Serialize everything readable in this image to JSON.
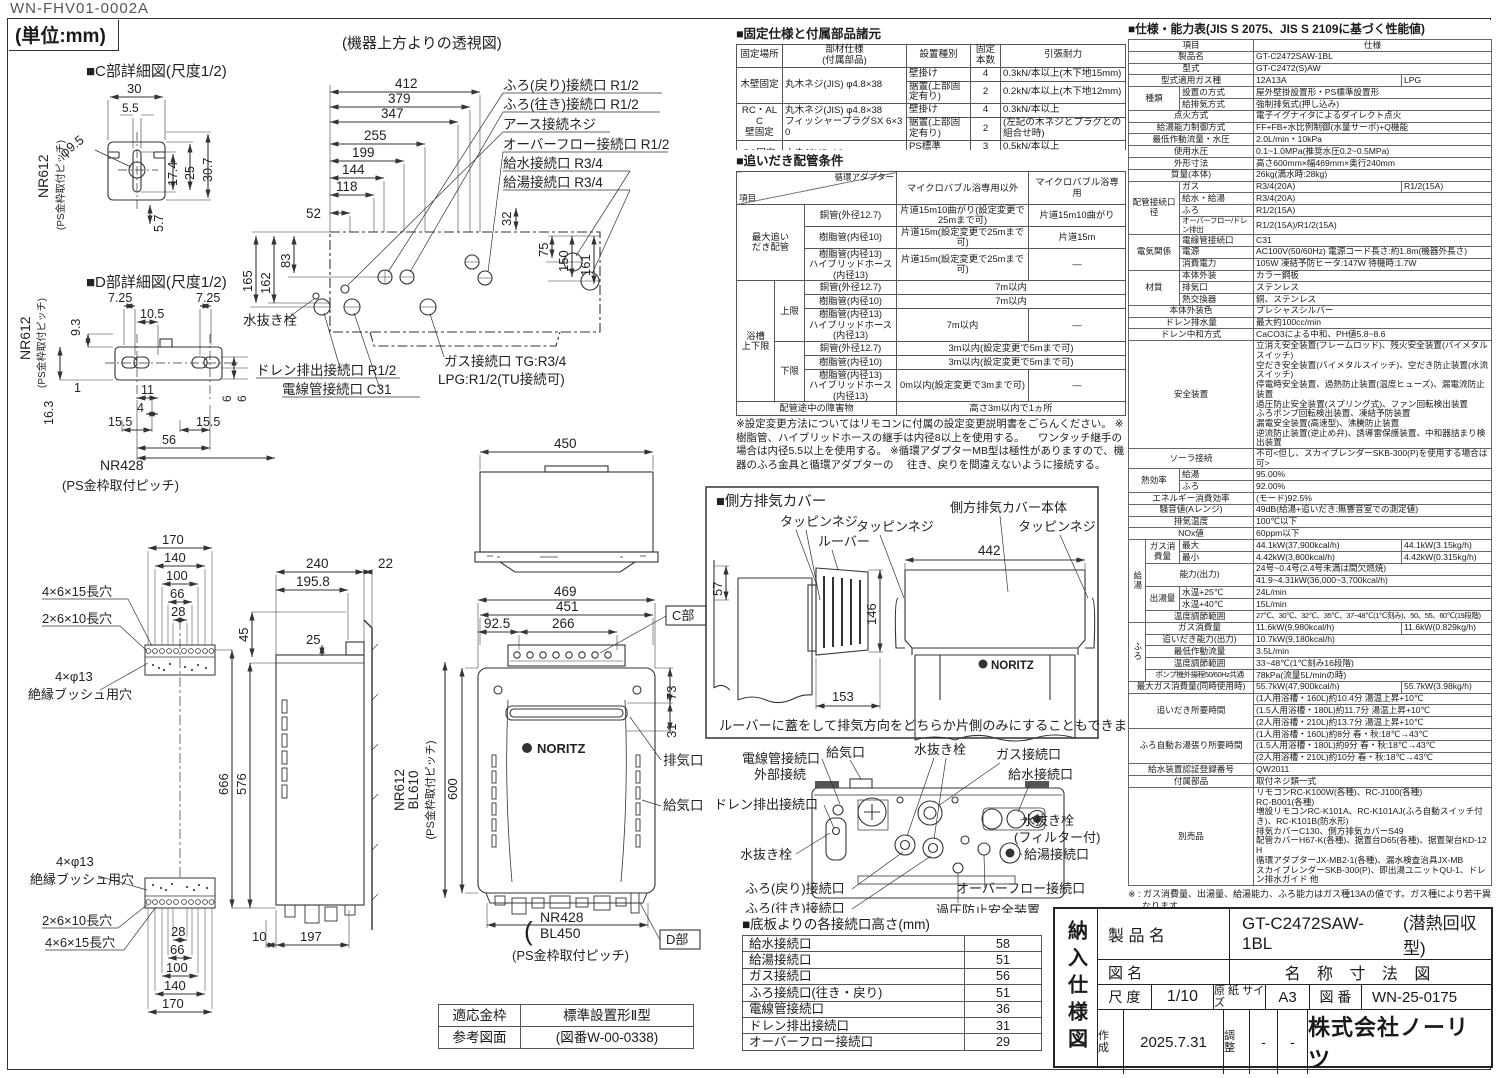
{
  "page": {
    "doc_code": "WN-FHV01-0002A",
    "unit_note": "(単位:mm)"
  },
  "c_detail": {
    "title": "■C部詳細図(尺度1/2)",
    "d30": "30",
    "d55": "5.5",
    "dphi": "φ9.5",
    "d174": "17.4",
    "d25": "25",
    "d307": "30.7",
    "d57": "5.7",
    "pitch": "NR612",
    "pitch_sub": "(PS金枠取付ピッチ)"
  },
  "d_detail": {
    "title": "■D部詳細図(尺度1/2)",
    "d725l": "7.25",
    "d105": "10.5",
    "d725r": "7.25",
    "d93": "9.3",
    "d1": "1",
    "d163": "16.3",
    "d11": "11",
    "d4": "4",
    "d155l": "15.5",
    "d155r": "15.5",
    "d56": "56",
    "d6a": "6",
    "d6b": "6",
    "pitch": "NR612",
    "pitch_sub": "(PS金枠取付ピッチ)",
    "pitch2": "NR428",
    "pitch2_sub": "(PS金枠取付ピッチ)"
  },
  "top_view": {
    "title": "(機器上方よりの透視図)",
    "d412": "412",
    "d379": "379",
    "d347": "347",
    "d255": "255",
    "d199": "199",
    "d144": "144",
    "d118": "118",
    "d52": "52",
    "d165": "165",
    "d162": "162",
    "d83": "83",
    "d32": "32",
    "d75": "75",
    "d150": "150",
    "d161": "161",
    "labels": {
      "furo_return": "ふろ(戻り)接続口 R1/2",
      "furo_go": "ふろ(往き)接続口 R1/2",
      "earth": "アース接続ネジ",
      "overflow": "オーバーフロー接続口 R1/2",
      "water_in": "給水接続口 R3/4",
      "hot_out": "給湯接続口 R3/4",
      "drain_plug": "水抜き栓",
      "drain_out": "ドレン排出接続口 R1/2",
      "conduit": "電線管接続口 C31",
      "gas1": "ガス接続口 TG:R3/4",
      "gas2": "LPG:R1/2(TU接続可)"
    }
  },
  "front_view": {
    "d450": "450",
    "d469": "469",
    "d451": "451",
    "d925": "92.5",
    "d266": "266",
    "d73": "73",
    "d31": "31",
    "d600": "600",
    "c_part": "C部",
    "d_part": "D部",
    "exhaust": "排気口",
    "air_in": "給気口",
    "logo": "NORITZ",
    "nr612": "NR612",
    "bl610": "BL610",
    "ps_pitch_l": "(PS金枠取付ピッチ)",
    "nr428": "NR428",
    "bl450": "BL450",
    "ps_pitch_b": "(PS金枠取付ピッチ)"
  },
  "side_view": {
    "d240": "240",
    "d22": "22",
    "d1958": "195.8",
    "d25": "25",
    "d45": "45",
    "d666": "666",
    "d576": "576",
    "d10": "10",
    "d197": "197"
  },
  "brackets": {
    "hole_a": "4×6×15長穴",
    "hole_b": "2×6×10長穴",
    "hole_c": "4×φ13",
    "hole_c_sub": "絶縁ブッシュ用穴",
    "t170": "170",
    "t140": "140",
    "t100": "100",
    "t66": "66",
    "t28": "28",
    "b28": "28",
    "b66": "66",
    "b100": "100",
    "b140": "140",
    "b170": "170"
  },
  "side_cover": {
    "title": "■側方排気カバー",
    "tapping": "タッピンネジ",
    "louver": "ルーバー",
    "body_label": "側方排気カバー本体",
    "d57": "57",
    "d146": "146",
    "d153": "153",
    "d442": "442",
    "logo": "NORITZ",
    "note": "ルーバーに蓋をして排気方向をどちらか片側のみにすることもできます。"
  },
  "rear_view": {
    "conduit": "電線管接続口",
    "external": "外部接続",
    "air_in": "給気口",
    "drain_plug_top": "水抜き栓",
    "gas": "ガス接続口",
    "water_in": "給水接続口",
    "drain_out": "ドレン排出接続口",
    "drain_plug_left": "水抜き栓",
    "drain_plug_filter": "水抜き栓",
    "filter_sub": "(フィルター付)",
    "hot_out": "給湯接続口",
    "furo_return": "ふろ(戻り)接続口",
    "furo_go": "ふろ(往き)接続口",
    "overflow": "オーバーフロー接続口",
    "relief": "過圧防止安全装置",
    "relief_sub": "(水抜き栓付)"
  },
  "fix_table": {
    "title": "■固定仕様と付属部品諸元",
    "headers": [
      "固定場所",
      [
        "部材仕様",
        "(付属部品)"
      ],
      "設置種別",
      "固定本数",
      "引張耐力"
    ],
    "wood": {
      "place": "木壁固定",
      "part": "丸木ネジ(JIS) φ4.8×38",
      "t1": "壁掛け",
      "n1": "4",
      "p1": "0.3kN/本以上(木下地15mm)",
      "t2": "据置(上部固定有り)",
      "n2": "2",
      "p2": "0.2kN/本以上(木下地12mm)"
    },
    "rc": {
      "place": [
        "RC・ALC",
        "壁固定"
      ],
      "part": [
        "丸木ネジ(JIS) φ4.8×38",
        "フィッシャープラグSX 6×30"
      ],
      "t1": "壁掛け",
      "n1": "4",
      "p1": "0.3kN/本以上",
      "t2": "据置(上部固定有り)",
      "n2": "2",
      "p2": "(左記の木ネジとプラグとの組合せ時)"
    },
    "ps": {
      "place": "PS固定",
      "part": "小ネジM5×12",
      "t": "PS標準",
      "n": "3",
      "p": "0.5kN/本以上"
    },
    "note": [
      "※本製品の設置・転倒防止の措置は、国土交通省告示第1447号「建築設備の構造耐力上安全な構造方法を",
      "　定める件の一部を改訂する件」に対応しています。"
    ]
  },
  "oidaki": {
    "title": "■追いだき配管条件",
    "h_item": "項目",
    "h_adapter": "循環アダプター",
    "h_col1": "マイクロバブル浴専用以外",
    "h_col2": "マイクロバブル浴専用",
    "g1": [
      "最大追い",
      "だき配管"
    ],
    "g2": [
      "浴槽",
      "上下限"
    ],
    "sub_up": "上限",
    "sub_down": "下限",
    "pipe_cu": "銅管(外径12.7)",
    "pipe_resin": "樹脂管(内径10)",
    "pipe_resin13": [
      "樹脂管(内径13)",
      "ハイブリッドホース(内径13)"
    ],
    "r1v1": "片道15m10曲がり(設定変更で25mまで可)",
    "r1v2": "片道15m10曲がり",
    "r2v1": "片道15m(設定変更で25mまで可)",
    "r2v2": "片道15m",
    "r3v1": "片道15m(設定変更で25mまで可)",
    "dash": "―",
    "r4v": "7m以内",
    "r6v1": "7m以内",
    "r7v": "3m以内(設定変更で5mまで可)",
    "r9v1": "0m以内(設定変更で3mまで可)",
    "obstacle_label": "配管途中の障害物",
    "obstacle_value": "高さ3m以内で1ヵ所",
    "notes": [
      "※設定変更方法についてはリモコンに付属の設定変更説明書をごらんください。",
      "※樹脂管、ハイブリッドホースの継手は内径8以上を使用する。",
      "　ワンタッチ継手の場合は内径5.5以上を使用する。",
      "※循環アダプターMB型は極性がありますので、機器のふろ金具と循環アダプターの",
      "　往き、戻りを間違えないように接続する。"
    ]
  },
  "spec": {
    "title": "■仕様・能力表(JIS S 2075、JIS S 2109に基づく性能値)",
    "rows": [
      [
        "項目",
        "仕様"
      ],
      [
        "製品名",
        "GT-C2472SAW-1BL"
      ],
      [
        "型式",
        "GT-C2472(S)AW"
      ],
      [
        "型式適用ガス種",
        "12A13A",
        "LPG"
      ],
      [
        "種類",
        "設置の方式",
        "屋外壁掛設置形・PS標準設置形"
      ],
      [
        "給排気方式",
        "強制排気式(押し込み)"
      ],
      [
        "点火方式",
        "電子イグナイタによるダイレクト点火"
      ],
      [
        "給湯能力制御方式",
        "FF+FB+水比例制御(水量サーボ)+Q機能"
      ],
      [
        "最低作動流量・水圧",
        "2.0L/min・10kPa"
      ],
      [
        "使用水圧",
        "0.1~1.0MPa(推奨水圧0.2~0.5MPa)"
      ],
      [
        "外形寸法",
        "高さ600mm×幅469mm×奥行240mm"
      ],
      [
        "質量(本体)",
        "26kg(満水時:28kg)"
      ],
      [
        "配管接続口径",
        "ガス",
        "R3/4(20A)",
        "R1/2(15A)"
      ],
      [
        "給水・給湯",
        "R3/4(20A)"
      ],
      [
        "ふろ",
        "R1/2(15A)"
      ],
      [
        "オーバーフロー/ドレン排出",
        "R1/2(15A)/R1/2(15A)"
      ],
      [
        "電気関係",
        "電線管接続口",
        "C31"
      ],
      [
        "電源",
        "AC100V(50/60Hz) 電源コード長さ:約1.8m(機器外長さ)"
      ],
      [
        "消費電力",
        "105W 凍結予防ヒータ:147W 待機時:1.7W"
      ],
      [
        "材質",
        "本体外装",
        "カラー鋼板"
      ],
      [
        "排気口",
        "ステンレス"
      ],
      [
        "熱交換器",
        "銅、ステンレス"
      ],
      [
        "本体外装色",
        "プレシャスシルバー"
      ],
      [
        "ドレン排水量",
        "最大約100cc/min"
      ],
      [
        "ドレン中和方式",
        "CaCO3による中和、PH値5.8~8.6"
      ],
      [
        "安全装置",
        [
          "立消え安全装置(フレームロッド)、残火安全装置(バイメタルスイッチ)",
          "空だき安全装置(バイメタルスイッチ)、空だき防止装置(水流スイッチ)",
          "停電時安全装置、過熱防止装置(温度ヒューズ)、漏電流防止装置",
          "過圧防止安全装置(スプリング式)、ファン回転検出装置",
          "ふろポンプ回転検出装置、凍結予防装置",
          "漏電安全装置(高速型)、沸騰防止装置",
          "逆流防止装置(逆止め弁)、誘導雷保護装置、中和器詰まり検出装置"
        ]
      ],
      [
        "ソーラ接続",
        "不可<但し、スカイブレンダーSKB-300(P)を使用する場合は可>"
      ],
      [
        "熱効率",
        "給湯",
        "95.00%"
      ],
      [
        "ふろ",
        "92.00%"
      ],
      [
        "エネルギー消費効率",
        "(モード)92.5%"
      ],
      [
        "騒音値(Aレンジ)",
        "49dB(給湯+追いだき:無響音室での測定値)"
      ],
      [
        "排気温度",
        "100℃以下"
      ],
      [
        "NOx値",
        "60ppm以下"
      ],
      [
        "給湯",
        "ガス消費量",
        "最大",
        "44.1kW(37,900kcal/h)",
        "44.1kW(3.15kg/h)"
      ],
      [
        "最小",
        "4.42kW(3,800kcal/h)",
        "4.42kW(0.315kg/h)"
      ],
      [
        "能力(出力)",
        "24号~0.4号(2.4号未満は間欠燃焼)"
      ],
      [
        "41.9~4.31kW(36,000~3,700kcal/h)"
      ],
      [
        "出湯量",
        "水温+25℃",
        "24L/min"
      ],
      [
        "水温+40℃",
        "15L/min"
      ],
      [
        "温度調節範囲",
        "27℃、30℃、32℃、35℃、37~48℃(1℃刻み)、50、55、60℃(19段階)"
      ],
      [
        "ふろ",
        "ガス消費量",
        "11.6kW(9,980kcal/h)",
        "11.6kW(0.829kg/h)"
      ],
      [
        "追いだき能力(出力)",
        "10.7kW(9,180kcal/h)"
      ],
      [
        "最低作動流量",
        "3.5L/min"
      ],
      [
        "温度調節範囲",
        "33~48℃(1℃刻み16段階)"
      ],
      [
        "ポンプ機外揚程50/60Hz共通",
        "78kPa(流量5L/minの時)"
      ],
      [
        "最大ガス消費量(同時使用時)",
        "55.7kW(47,900kcal/h)",
        "55.7kW(3.98kg/h)"
      ],
      [
        "追いだき所要時間",
        "(1人用浴槽・160L)約10.4分 湯温上昇+10℃"
      ],
      [
        "(1.5人用浴槽・180L)約11.7分 湯温上昇+10℃"
      ],
      [
        "(2人用浴槽・210L)約13.7分 湯温上昇+10℃"
      ],
      [
        "ふろ自動お湯張り所要時間",
        "(1人用浴槽・160L)約8分 春・秋:18℃→43℃"
      ],
      [
        "(1.5人用浴槽・180L)約9分 春・秋:18℃→43℃"
      ],
      [
        "(2人用浴槽・210L)約10分 春・秋:18℃→43℃"
      ],
      [
        "給水装置認証登録番号",
        "QW2011"
      ],
      [
        "付属部品",
        "取付ネジ類一式"
      ],
      [
        "別売品",
        [
          "リモコンRC-K100W(各種)、RC-J100(各種)",
          "RC-B001(各種)",
          "増設リモコンRC-K101A、RC-K101AJ(ふろ自動スイッチ付き)、RC-K101B(防水形)",
          "排気カバーC130、側方排気カバーS49",
          "配管カバーH67-K(各種)、据置台D65(各種)、据置架台KD-12H",
          "循環アダプターJX-MB2-1(各種)、漏水検査治具JX-MB",
          "スカイブレンダーSKB-300(P)、即出湯ユニットQU-1、ドレン排水ガイド 他"
        ]
      ]
    ],
    "notes": [
      "※ : ガス消費量、出湯量、給湯能力、ふろ能力はガス種13Aの値です。ガス種により若干異なります。",
      "※ : ふろ能力の条件はふろ配管片道3曲がり6m、φ12.7システムチューブ、給水圧294kPa=3.0kgf/cm²以上の場合になります。",
      "※ : 各特性値及び付属部品、別売品は予告なく変更する事があります。"
    ],
    "notes2_title": "■注記",
    "notes2": [
      "※ 標準塗装は(一社)日本冷凍空調工業会標準規格(JRA9002)の耐塩害仕様に準拠しています。",
      "※ この機器は燃焼時に「ドレン排出口」からドレンが排出されます。必ず排水配管を設置し、排水口まで配管し先端は大気開放にして、水につからないようにしてください。",
      "※ この機器は側面近接10mmに対応しています。"
    ]
  },
  "height_table": {
    "title": "■底板よりの各接続口高さ(mm)",
    "rows": [
      [
        "給水接続口",
        "58"
      ],
      [
        "給湯接続口",
        "51"
      ],
      [
        "ガス接続口",
        "56"
      ],
      [
        "ふろ接続口(往き・戻り)",
        "51"
      ],
      [
        "電線管接続口",
        "36"
      ],
      [
        "ドレン排出接続口",
        "31"
      ],
      [
        "オーバーフロー接続口",
        "29"
      ]
    ]
  },
  "kanewaku": {
    "r1c1": "適応金枠",
    "r1c2": "標準設置形Ⅱ型",
    "r2c1": "参考図面",
    "r2c2": "(図番W-00-0338)"
  },
  "titleblock": {
    "side": "納入仕様図",
    "product_label": "製 品 名",
    "product_name": "GT-C2472SAW-1BL",
    "product_type": "(潜熱回収型)",
    "drawing_label": "図 名",
    "drawing_name": "名 称 寸 法 図",
    "scale_label": "尺 度",
    "scale": "1/10",
    "paper_label": [
      "原 紙",
      "サイズ"
    ],
    "paper": "A3",
    "no_label": "図 番",
    "no": "WN-25-0175",
    "created_label": [
      "作",
      "成"
    ],
    "created": "2025.7.31",
    "adjust_label": [
      "調",
      "整"
    ],
    "adjust1": "-",
    "adjust2": "-",
    "company": "株式会社ノーリツ"
  }
}
